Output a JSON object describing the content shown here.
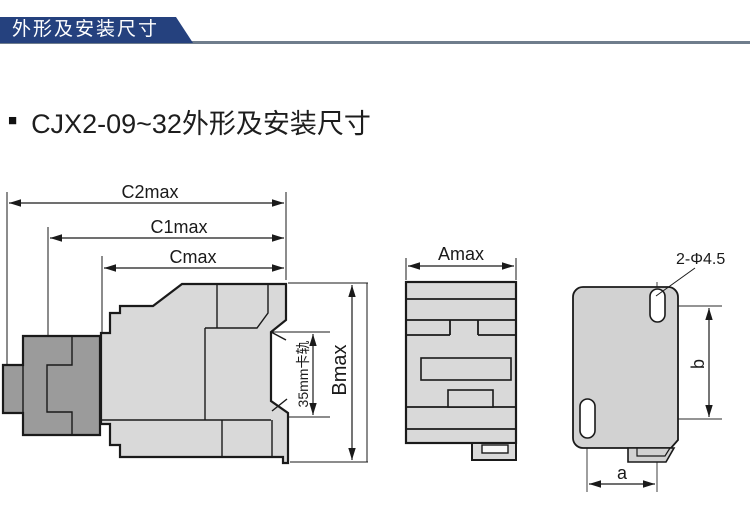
{
  "header": {
    "title": "外形及安装尺寸"
  },
  "section": {
    "bullet": "■",
    "title": "CJX2-09~32外形及安装尺寸"
  },
  "side_view": {
    "dim_c2max": "C2max",
    "dim_c1max": "C1max",
    "dim_cmax": "Cmax",
    "dim_bmax": "Bmax",
    "din_rail_label": "35mm卡轨"
  },
  "front_view": {
    "dim_amax": "Amax"
  },
  "mounting_view": {
    "holes_label": "2-Φ4.5",
    "dim_b": "b",
    "dim_a": "a"
  },
  "colors": {
    "header_bar": "#25417e",
    "header_text": "#ffffff",
    "rule": "#6f7d8c",
    "body_fill": "#d9d9d9",
    "plate_fill": "#d2d2d2",
    "dark_block_fill": "#9b9b9b",
    "line": "#1a1a1a",
    "background": "#ffffff"
  }
}
